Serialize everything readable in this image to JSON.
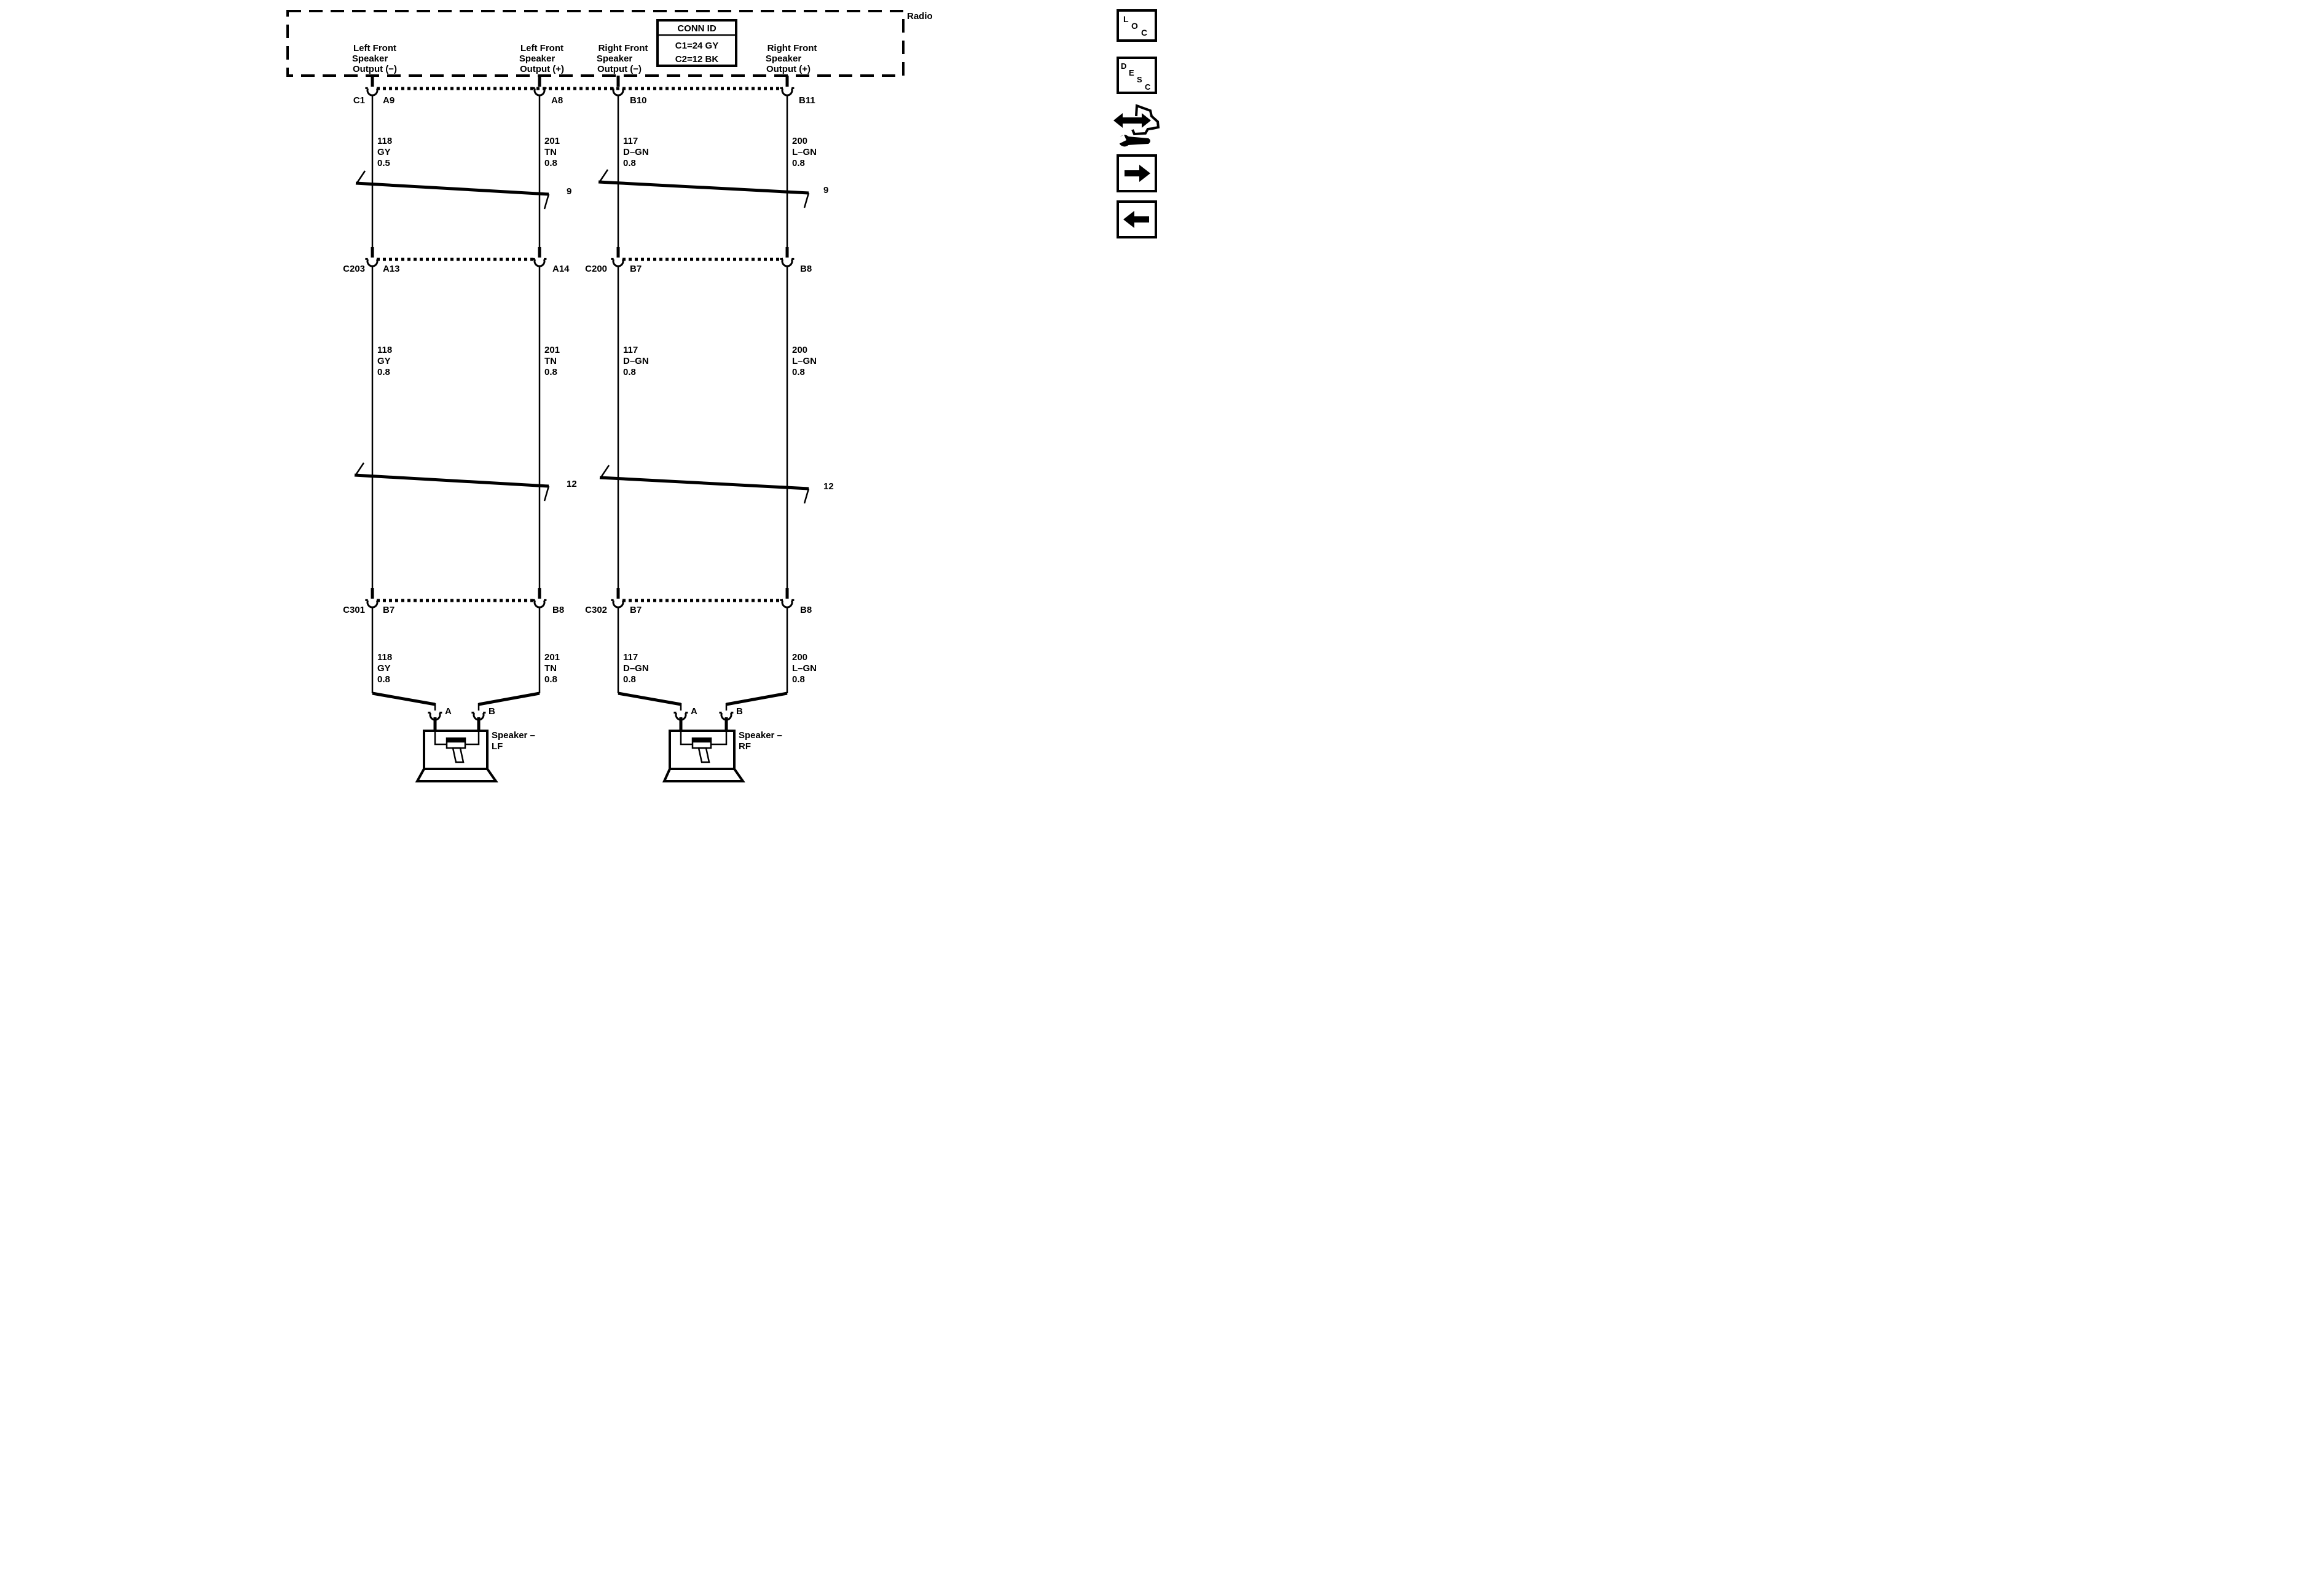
{
  "radio": {
    "label": "Radio",
    "conn_id": {
      "title": "CONN ID",
      "line1": "C1=24 GY",
      "line2": "C2=12 BK"
    },
    "outputs": [
      {
        "l1": "Left Front",
        "l2": "Speaker",
        "l3": "Output (−)"
      },
      {
        "l1": "Left Front",
        "l2": "Speaker",
        "l3": "Output (+)"
      },
      {
        "l1": "Right Front",
        "l2": "Speaker",
        "l3": "Output (−)"
      },
      {
        "l1": "Right Front",
        "l2": "Speaker",
        "l3": "Output (+)"
      }
    ]
  },
  "connectors": {
    "c1": {
      "name": "C1",
      "pin1": "A9",
      "pin2": "A8",
      "pin3": "B10",
      "pin4": "B11"
    },
    "c203": {
      "name": "C203",
      "pin1": "A13",
      "pin2": "A14"
    },
    "c200": {
      "name": "C200",
      "pin1": "B7",
      "pin2": "B8"
    },
    "c301": {
      "name": "C301",
      "pin1": "B7",
      "pin2": "B8"
    },
    "c302": {
      "name": "C302",
      "pin1": "B7",
      "pin2": "B8"
    }
  },
  "harness_ids": {
    "top": "9",
    "bottom": "12"
  },
  "wire_labels": {
    "top": [
      {
        "circuit": "118",
        "color": "GY",
        "size": "0.5"
      },
      {
        "circuit": "201",
        "color": "TN",
        "size": "0.8"
      },
      {
        "circuit": "117",
        "color": "D–GN",
        "size": "0.8"
      },
      {
        "circuit": "200",
        "color": "L–GN",
        "size": "0.8"
      }
    ],
    "middle": [
      {
        "circuit": "118",
        "color": "GY",
        "size": "0.8"
      },
      {
        "circuit": "201",
        "color": "TN",
        "size": "0.8"
      },
      {
        "circuit": "117",
        "color": "D–GN",
        "size": "0.8"
      },
      {
        "circuit": "200",
        "color": "L–GN",
        "size": "0.8"
      }
    ],
    "bottom": [
      {
        "circuit": "118",
        "color": "GY",
        "size": "0.8"
      },
      {
        "circuit": "201",
        "color": "TN",
        "size": "0.8"
      },
      {
        "circuit": "117",
        "color": "D–GN",
        "size": "0.8"
      },
      {
        "circuit": "200",
        "color": "L–GN",
        "size": "0.8"
      }
    ]
  },
  "speakers": {
    "left": {
      "pin_a": "A",
      "pin_b": "B",
      "name_line1": "Speaker –",
      "name_line2": "LF"
    },
    "right": {
      "pin_a": "A",
      "pin_b": "B",
      "name_line1": "Speaker –",
      "name_line2": "RF"
    }
  },
  "side_toolbar": {
    "loc": [
      "L",
      "O",
      "C"
    ],
    "desc": [
      "D",
      "E",
      "S",
      "C"
    ]
  },
  "colors": {
    "ink": "#000000",
    "background": "#ffffff"
  }
}
